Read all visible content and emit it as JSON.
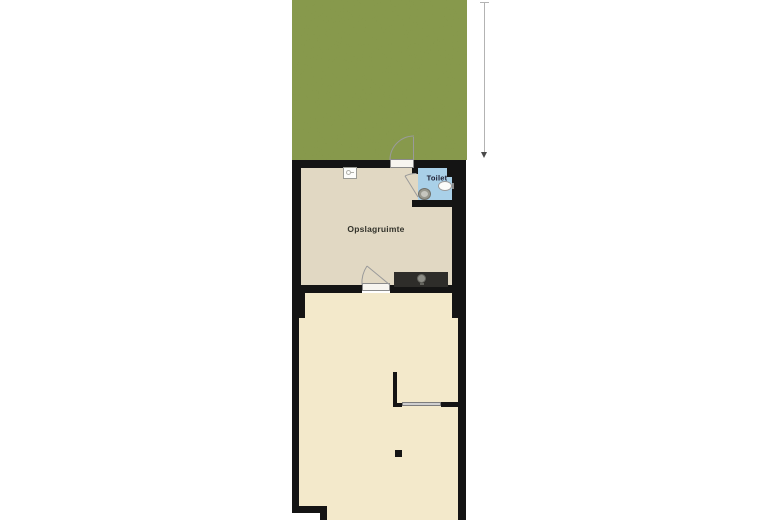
{
  "plan": {
    "kind": "residential floor plan with garden",
    "labels": {
      "storage_room": "Opslagruimte",
      "toilet_room": "Toilet"
    },
    "colors": {
      "garden": "#7c8e41",
      "storage_floor": "#e1d8c3",
      "main_floor": "#f3e9cb",
      "toilet_floor": "#a9d0e8",
      "wall": "#141414",
      "counter": "#2e2d2a",
      "door_arc": "#9a9a9a",
      "background": "#ffffff"
    },
    "icons": {
      "boiler": "boiler-unit-icon",
      "lamp": "lamp-icon",
      "sink": "sink-icon",
      "toilet_bowl": "toilet-bowl-icon",
      "dimension": "dimension-arrow-icon"
    }
  }
}
